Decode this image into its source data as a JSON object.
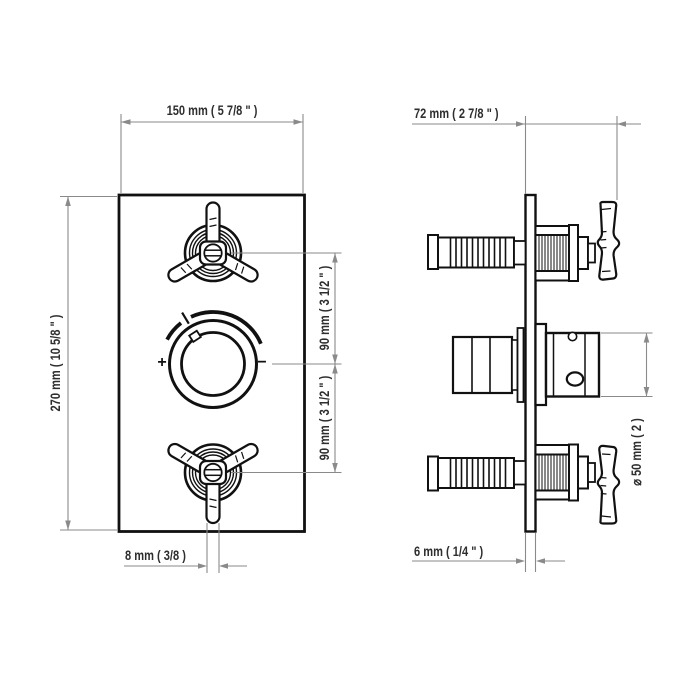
{
  "drawing_type": "thermostatic-shower-valve-technical-drawing",
  "front_view": {
    "width": "150 mm ( 5 7/8 \" )",
    "height": "270 mm ( 10 5/8 \" )",
    "upper_spacing": "90 mm ( 3 1/2 \" )",
    "lower_spacing": "90 mm ( 3 1/2 \" )",
    "spoke_width": "8 mm ( 3/8 )",
    "dial_plus": "+",
    "dial_minus": "−"
  },
  "side_view": {
    "depth": "72 mm ( 2 7/8 \" )",
    "plate_thickness": "6 mm ( 1/4 \" )",
    "dial_diameter": "⌀ 50 mm ( 2 )"
  },
  "colors": {
    "object_line": "#111111",
    "dimension_line": "#8a8a8a",
    "text": "#2e2e2e",
    "background": "#ffffff"
  }
}
